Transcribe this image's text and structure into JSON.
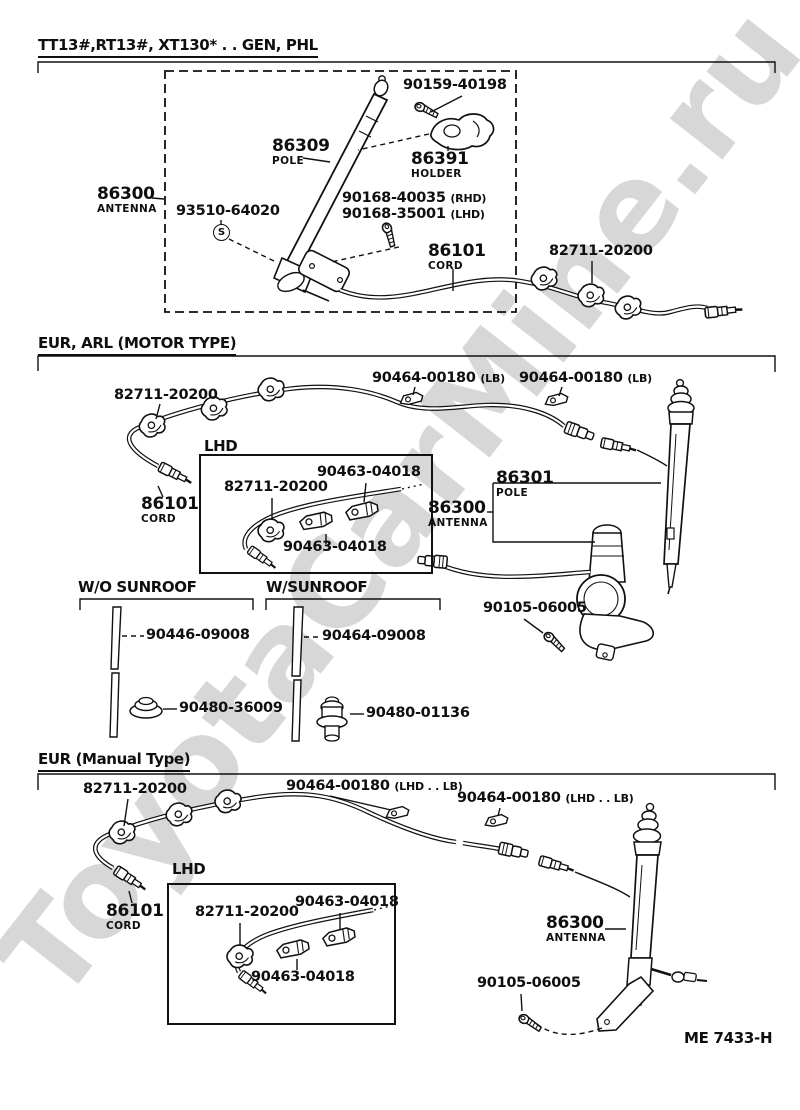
{
  "watermark": "ToyotaCarMine.ru",
  "doc_code": "ME 7433-H",
  "gen": {
    "title": "TT13#,RT13#, XT130* . . GEN, PHL",
    "screw_holder": "90159-40198",
    "pole_num": "86309",
    "pole_cap": "POLE",
    "holder_num": "86391",
    "holder_cap": "HOLDER",
    "antenna_num": "86300",
    "antenna_cap": "ANTENNA",
    "screw_set": "93510-64020",
    "screw_set_symbol": "S",
    "nut_rhd_num": "90168-40035",
    "nut_rhd_sfx": "(RHD)",
    "nut_lhd_num": "90168-35001",
    "nut_lhd_sfx": "(LHD)",
    "cord_num": "86101",
    "cord_cap": "CORD",
    "clip": "82711-20200"
  },
  "motor": {
    "title": "EUR, ARL (MOTOR TYPE)",
    "clip": "82711-20200",
    "clamp_left_num": "90464-00180",
    "clamp_left_sfx": "(LB)",
    "clamp_right_num": "90464-00180",
    "clamp_right_sfx": "(LB)",
    "lhd_title": "LHD",
    "lhd_clip": "82711-20200",
    "lhd_clamp_top": "90463-04018",
    "lhd_clamp_bottom": "90463-04018",
    "cord_num": "86101",
    "cord_cap": "CORD",
    "pole_num": "86301",
    "pole_cap": "POLE",
    "antenna_num": "86300",
    "antenna_cap": "ANTENNA",
    "screw": "90105-06005"
  },
  "sunroof": {
    "without_title": "W/O SUNROOF",
    "with_title": "W/SUNROOF",
    "without_tube": "90446-09008",
    "without_grommet": "90480-36009",
    "with_tube": "90464-09008",
    "with_grommet": "90480-01136"
  },
  "manual": {
    "title": "EUR (Manual Type)",
    "clip": "82711-20200",
    "clamp_left_num": "90464-00180",
    "clamp_left_sfx": "(LHD . . LB)",
    "clamp_right_num": "90464-00180",
    "clamp_right_sfx": "(LHD . . LB)",
    "lhd_title": "LHD",
    "lhd_clip": "82711-20200",
    "lhd_clamp_top": "90463-04018",
    "lhd_clamp_bottom": "90463-04018",
    "cord_num": "86101",
    "cord_cap": "CORD",
    "antenna_num": "86300",
    "antenna_cap": "ANTENNA",
    "screw": "90105-06005"
  }
}
